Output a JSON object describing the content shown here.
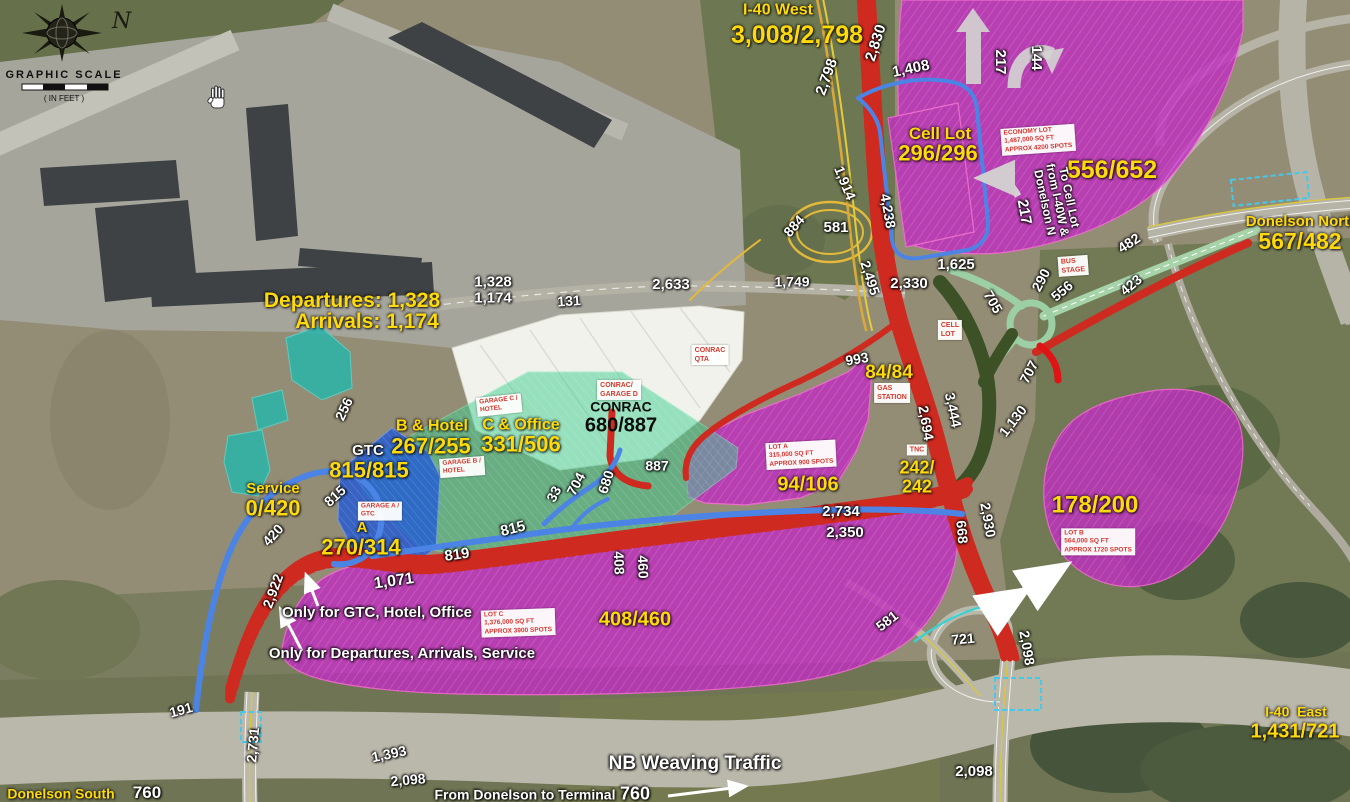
{
  "compass": {
    "n": "N",
    "scale_title": "GRAPHIC SCALE",
    "scale_units": "( IN FEET )"
  },
  "colors": {
    "lot_magenta": "#c02fc0",
    "garage_green": "#3ecf8f",
    "garage_blue": "#1f58d8",
    "curb_teal": "#2ab5ab",
    "road_red": "#cf2a20",
    "road_blue": "#4c84e6",
    "road_yellow": "#e5b93a",
    "road_pale_green": "#9ccfa4",
    "ramp_dark_green": "#3c5126",
    "label_yellow": "#ffd90a",
    "sign_red": "#d5372d"
  },
  "labels": [
    {
      "n": "label-i40-west",
      "t": "I-40 West",
      "x": 778,
      "y": 11,
      "r": 0,
      "s": 16,
      "c": "y"
    },
    {
      "n": "count-i40-west",
      "t": "3,008/2,798",
      "x": 797,
      "y": 35,
      "r": 0,
      "s": 25,
      "c": "y"
    },
    {
      "n": "label-cell-lot",
      "t": "Cell Lot",
      "x": 940,
      "y": 134,
      "r": 0,
      "s": 17,
      "c": "y"
    },
    {
      "n": "count-cell-lot",
      "t": "296/296",
      "x": 938,
      "y": 154,
      "r": 0,
      "s": 22,
      "c": "y"
    },
    {
      "n": "count-economy-lot",
      "t": "556/652",
      "x": 1112,
      "y": 170,
      "r": 0,
      "s": 25,
      "c": "y"
    },
    {
      "n": "label-donelson-north",
      "t": "Donelson North",
      "x": 1302,
      "y": 222,
      "r": 0,
      "s": 15,
      "c": "y"
    },
    {
      "n": "count-donelson-north",
      "t": "567/482",
      "x": 1300,
      "y": 242,
      "r": 0,
      "s": 23,
      "c": "y"
    },
    {
      "n": "label-departures",
      "t": "Departures: 1,328",
      "x": 352,
      "y": 301,
      "r": 0,
      "s": 21,
      "c": "y"
    },
    {
      "n": "label-arrivals",
      "t": "Arrivals: 1,174",
      "x": 367,
      "y": 322,
      "r": 0,
      "s": 21,
      "c": "y"
    },
    {
      "n": "label-garage-b-hotel",
      "t": "B & Hotel",
      "x": 432,
      "y": 427,
      "r": 0,
      "s": 16,
      "c": "y"
    },
    {
      "n": "count-garage-b-hotel",
      "t": "267/255",
      "x": 431,
      "y": 447,
      "r": 0,
      "s": 22,
      "c": "y"
    },
    {
      "n": "label-garage-c-office",
      "t": "C & Office",
      "x": 521,
      "y": 426,
      "r": 0,
      "s": 16,
      "c": "y"
    },
    {
      "n": "count-garage-c-office",
      "t": "331/506",
      "x": 521,
      "y": 445,
      "r": 0,
      "s": 22,
      "c": "y"
    },
    {
      "n": "label-gtc",
      "t": "GTC",
      "x": 368,
      "y": 451,
      "r": 0,
      "s": 15,
      "c": "w"
    },
    {
      "n": "count-gtc",
      "t": "815/815",
      "x": 369,
      "y": 471,
      "r": 0,
      "s": 22,
      "c": "y"
    },
    {
      "n": "label-garage-a",
      "t": "A",
      "x": 362,
      "y": 528,
      "r": 0,
      "s": 15,
      "c": "y"
    },
    {
      "n": "count-garage-a",
      "t": "270/314",
      "x": 361,
      "y": 548,
      "r": 0,
      "s": 22,
      "c": "y"
    },
    {
      "n": "label-service",
      "t": "Service",
      "x": 273,
      "y": 489,
      "r": 0,
      "s": 15,
      "c": "y"
    },
    {
      "n": "count-service",
      "t": "0/420",
      "x": 273,
      "y": 509,
      "r": 0,
      "s": 22,
      "c": "y"
    },
    {
      "n": "count-lot-a",
      "t": "94/106",
      "x": 808,
      "y": 485,
      "r": 0,
      "s": 20,
      "c": "y"
    },
    {
      "n": "count-gas-station",
      "t": "84/84",
      "x": 889,
      "y": 373,
      "r": 0,
      "s": 19,
      "c": "y"
    },
    {
      "n": "count-tnc",
      "t": "242/\n242",
      "x": 917,
      "y": 477,
      "r": 0,
      "s": 18,
      "c": "y"
    },
    {
      "n": "count-lot-c",
      "t": "408/460",
      "x": 635,
      "y": 620,
      "r": 0,
      "s": 20,
      "c": "y"
    },
    {
      "n": "count-lot-b",
      "t": "178/200",
      "x": 1095,
      "y": 506,
      "r": 0,
      "s": 24,
      "c": "y"
    },
    {
      "n": "label-i40-east",
      "t": "I-40  East",
      "x": 1296,
      "y": 712,
      "r": 0,
      "s": 14,
      "c": "y"
    },
    {
      "n": "count-i40-east",
      "t": "1,431/721",
      "x": 1295,
      "y": 732,
      "r": 0,
      "s": 20,
      "c": "y"
    },
    {
      "n": "label-donelson-south",
      "t": "Donelson South",
      "x": 61,
      "y": 794,
      "r": 0,
      "s": 14,
      "c": "y"
    },
    {
      "n": "count-2798",
      "t": "2,798",
      "x": 827,
      "y": 77,
      "r": -70,
      "s": 15,
      "c": "w"
    },
    {
      "n": "count-2830",
      "t": "2,830",
      "x": 876,
      "y": 43,
      "r": -72,
      "s": 15,
      "c": "w"
    },
    {
      "n": "count-1408",
      "t": "1,408",
      "x": 911,
      "y": 69,
      "r": -12,
      "s": 15,
      "c": "w"
    },
    {
      "n": "count-217-up",
      "t": "217",
      "x": 1000,
      "y": 62,
      "r": 90,
      "s": 15,
      "c": "w"
    },
    {
      "n": "count-144",
      "t": "144",
      "x": 1036,
      "y": 58,
      "r": 90,
      "s": 15,
      "c": "w"
    },
    {
      "n": "count-217-cell",
      "t": "217",
      "x": 1024,
      "y": 212,
      "r": 80,
      "s": 15,
      "c": "w"
    },
    {
      "n": "note-to-cell-lot",
      "t": "To Cell Lot\nfrom I-40W &\nDonelson N",
      "x": 1057,
      "y": 200,
      "r": 78,
      "s": 12,
      "c": "w"
    },
    {
      "n": "count-1914",
      "t": "1,914",
      "x": 845,
      "y": 183,
      "r": 68,
      "s": 14,
      "c": "w"
    },
    {
      "n": "count-4238",
      "t": "4,238",
      "x": 888,
      "y": 211,
      "r": 80,
      "s": 14,
      "c": "w"
    },
    {
      "n": "count-884",
      "t": "884",
      "x": 794,
      "y": 226,
      "r": -48,
      "s": 14,
      "c": "w"
    },
    {
      "n": "count-581-loop",
      "t": "581",
      "x": 836,
      "y": 228,
      "r": 0,
      "s": 15,
      "c": "w"
    },
    {
      "n": "count-1749",
      "t": "1,749",
      "x": 792,
      "y": 282,
      "r": 0,
      "s": 14,
      "c": "w"
    },
    {
      "n": "count-2495",
      "t": "2,495",
      "x": 870,
      "y": 278,
      "r": 72,
      "s": 14,
      "c": "w"
    },
    {
      "n": "count-2330",
      "t": "2,330",
      "x": 909,
      "y": 284,
      "r": 0,
      "s": 15,
      "c": "w"
    },
    {
      "n": "count-1625",
      "t": "1,625",
      "x": 956,
      "y": 265,
      "r": 0,
      "s": 15,
      "c": "w"
    },
    {
      "n": "count-705",
      "t": "705",
      "x": 993,
      "y": 302,
      "r": 60,
      "s": 14,
      "c": "w"
    },
    {
      "n": "count-290",
      "t": "290",
      "x": 1041,
      "y": 280,
      "r": -62,
      "s": 14,
      "c": "w"
    },
    {
      "n": "count-556",
      "t": "556",
      "x": 1062,
      "y": 291,
      "r": -40,
      "s": 14,
      "c": "w"
    },
    {
      "n": "count-482",
      "t": "482",
      "x": 1129,
      "y": 243,
      "r": -33,
      "s": 14,
      "c": "w"
    },
    {
      "n": "count-423",
      "t": "423",
      "x": 1131,
      "y": 285,
      "r": -40,
      "s": 14,
      "c": "w"
    },
    {
      "n": "count-707",
      "t": "707",
      "x": 1029,
      "y": 372,
      "r": -62,
      "s": 14,
      "c": "w"
    },
    {
      "n": "count-1130",
      "t": "1,130",
      "x": 1013,
      "y": 421,
      "r": -52,
      "s": 14,
      "c": "w"
    },
    {
      "n": "count-3444",
      "t": "3,444",
      "x": 953,
      "y": 410,
      "r": 78,
      "s": 14,
      "c": "w"
    },
    {
      "n": "count-2694",
      "t": "2,694",
      "x": 926,
      "y": 423,
      "r": 80,
      "s": 14,
      "c": "w"
    },
    {
      "n": "count-993",
      "t": "993",
      "x": 857,
      "y": 359,
      "r": -10,
      "s": 14,
      "c": "w"
    },
    {
      "n": "count-2734",
      "t": "2,734",
      "x": 841,
      "y": 512,
      "r": 0,
      "s": 15,
      "c": "w"
    },
    {
      "n": "count-2350",
      "t": "2,350",
      "x": 845,
      "y": 533,
      "r": 0,
      "s": 15,
      "c": "w"
    },
    {
      "n": "count-668",
      "t": "668",
      "x": 962,
      "y": 532,
      "r": 85,
      "s": 14,
      "c": "w"
    },
    {
      "n": "count-2930",
      "t": "2,930",
      "x": 988,
      "y": 520,
      "r": 80,
      "s": 14,
      "c": "w"
    },
    {
      "n": "count-887",
      "t": "887",
      "x": 657,
      "y": 466,
      "r": 0,
      "s": 14,
      "c": "w"
    },
    {
      "n": "count-680",
      "t": "680",
      "x": 606,
      "y": 482,
      "r": -72,
      "s": 14,
      "c": "w"
    },
    {
      "n": "count-704",
      "t": "704",
      "x": 576,
      "y": 484,
      "r": -62,
      "s": 14,
      "c": "w"
    },
    {
      "n": "count-33",
      "t": "33",
      "x": 554,
      "y": 494,
      "r": -62,
      "s": 14,
      "c": "w"
    },
    {
      "n": "count-815-road",
      "t": "815",
      "x": 513,
      "y": 529,
      "r": -14,
      "s": 15,
      "c": "w"
    },
    {
      "n": "count-815-gtc",
      "t": "815",
      "x": 335,
      "y": 496,
      "r": -42,
      "s": 14,
      "c": "w"
    },
    {
      "n": "count-819",
      "t": "819",
      "x": 457,
      "y": 555,
      "r": -8,
      "s": 15,
      "c": "w"
    },
    {
      "n": "count-1071",
      "t": "1,071",
      "x": 394,
      "y": 582,
      "r": -8,
      "s": 16,
      "c": "w"
    },
    {
      "n": "count-2922",
      "t": "2,922",
      "x": 273,
      "y": 591,
      "r": -70,
      "s": 14,
      "c": "w"
    },
    {
      "n": "count-420",
      "t": "420",
      "x": 273,
      "y": 535,
      "r": -48,
      "s": 14,
      "c": "w"
    },
    {
      "n": "count-256",
      "t": "256",
      "x": 344,
      "y": 409,
      "r": -65,
      "s": 14,
      "c": "w"
    },
    {
      "n": "count-408",
      "t": "408",
      "x": 619,
      "y": 563,
      "r": 88,
      "s": 14,
      "c": "w"
    },
    {
      "n": "count-460",
      "t": "460",
      "x": 643,
      "y": 567,
      "r": 88,
      "s": 14,
      "c": "w"
    },
    {
      "n": "count-131",
      "t": "131",
      "x": 569,
      "y": 301,
      "r": -4,
      "s": 14,
      "c": "w"
    },
    {
      "n": "count-2633",
      "t": "2,633",
      "x": 671,
      "y": 285,
      "r": 0,
      "s": 15,
      "c": "w"
    },
    {
      "n": "count-curb-stack",
      "t": "1,328\n1,174",
      "x": 493,
      "y": 290,
      "r": 0,
      "s": 15,
      "c": "w"
    },
    {
      "n": "count-581-ramp",
      "t": "581",
      "x": 887,
      "y": 621,
      "r": -38,
      "s": 14,
      "c": "w"
    },
    {
      "n": "count-721",
      "t": "721",
      "x": 963,
      "y": 639,
      "r": -5,
      "s": 14,
      "c": "w"
    },
    {
      "n": "count-2098-vert",
      "t": "2,098",
      "x": 1027,
      "y": 648,
      "r": 80,
      "s": 14,
      "c": "w"
    },
    {
      "n": "count-191",
      "t": "191",
      "x": 181,
      "y": 710,
      "r": -15,
      "s": 14,
      "c": "w"
    },
    {
      "n": "count-2731",
      "t": "2,731",
      "x": 253,
      "y": 745,
      "r": -85,
      "s": 14,
      "c": "w"
    },
    {
      "n": "count-1393",
      "t": "1,393",
      "x": 389,
      "y": 754,
      "r": -12,
      "s": 14,
      "c": "w"
    },
    {
      "n": "count-2098-left",
      "t": "2,098",
      "x": 408,
      "y": 780,
      "r": -5,
      "s": 14,
      "c": "w"
    },
    {
      "n": "count-760-left",
      "t": "760",
      "x": 147,
      "y": 793,
      "r": 0,
      "s": 17,
      "c": "w"
    },
    {
      "n": "note-from-donelson",
      "t": "From Donelson to Terminal",
      "x": 525,
      "y": 795,
      "r": 0,
      "s": 14,
      "c": "w"
    },
    {
      "n": "count-760-mid",
      "t": "760",
      "x": 635,
      "y": 794,
      "r": 0,
      "s": 18,
      "c": "w"
    },
    {
      "n": "label-nb-weaving",
      "t": "NB Weaving Traffic",
      "x": 695,
      "y": 764,
      "r": 0,
      "s": 19,
      "c": "w"
    },
    {
      "n": "count-2098-right",
      "t": "2,098",
      "x": 974,
      "y": 772,
      "r": 0,
      "s": 15,
      "c": "w"
    },
    {
      "n": "note-only-gtc",
      "t": "Only for GTC, Hotel, Office",
      "x": 377,
      "y": 613,
      "r": 0,
      "s": 15,
      "c": "w"
    },
    {
      "n": "note-only-departures",
      "t": "Only for Departures, Arrivals, Service",
      "x": 402,
      "y": 654,
      "r": 0,
      "s": 15,
      "c": "w"
    },
    {
      "n": "label-conrac",
      "t": "CONRAC",
      "x": 621,
      "y": 407,
      "r": 0,
      "s": 14,
      "c": "b"
    },
    {
      "n": "count-conrac",
      "t": "680/887",
      "x": 621,
      "y": 426,
      "r": 0,
      "s": 20,
      "c": "b"
    },
    {
      "n": "sign-economy-lot",
      "t": "ECONOMY LOT\n1,487,000 SQ FT\nAPPROX 4200 SPOTS",
      "x": 1038,
      "y": 140,
      "r": -4,
      "s": 6.5,
      "c": "s"
    },
    {
      "n": "sign-conrac-qta",
      "t": "CONRAC\nQTA",
      "x": 710,
      "y": 355,
      "r": 0,
      "s": 7,
      "c": "s"
    },
    {
      "n": "sign-conrac-garage-d",
      "t": "CONRAC/\nGARAGE D",
      "x": 619,
      "y": 390,
      "r": 0,
      "s": 7,
      "c": "s"
    },
    {
      "n": "sign-garage-c",
      "t": "GARAGE C /\nHOTEL",
      "x": 499,
      "y": 405,
      "r": -6,
      "s": 6.5,
      "c": "s"
    },
    {
      "n": "sign-garage-b",
      "t": "GARAGE B /\nHOTEL",
      "x": 462,
      "y": 467,
      "r": -4,
      "s": 6.5,
      "c": "s"
    },
    {
      "n": "sign-garage-a",
      "t": "GARAGE A /\nGTC",
      "x": 380,
      "y": 511,
      "r": 0,
      "s": 6.5,
      "c": "s"
    },
    {
      "n": "sign-lot-a",
      "t": "LOT A\n315,000 SQ FT\nAPPROX 900 SPOTS",
      "x": 801,
      "y": 455,
      "r": -3,
      "s": 6.5,
      "c": "s"
    },
    {
      "n": "sign-gas-station",
      "t": "GAS\nSTATION",
      "x": 892,
      "y": 393,
      "r": 0,
      "s": 7,
      "c": "s"
    },
    {
      "n": "sign-tnc",
      "t": "TNC",
      "x": 917,
      "y": 450,
      "r": 0,
      "s": 7,
      "c": "s"
    },
    {
      "n": "sign-cell-lot",
      "t": "CELL\nLOT",
      "x": 950,
      "y": 330,
      "r": 0,
      "s": 7,
      "c": "s"
    },
    {
      "n": "sign-bus-stage",
      "t": "BUS\nSTAGE",
      "x": 1073,
      "y": 266,
      "r": -4,
      "s": 7,
      "c": "s"
    },
    {
      "n": "sign-lot-b",
      "t": "LOT B\n564,000 SQ FT\nAPPROX 1720 SPOTS",
      "x": 1098,
      "y": 542,
      "r": 0,
      "s": 6.5,
      "c": "s"
    },
    {
      "n": "sign-lot-c",
      "t": "LOT C\n1,376,000 SQ FT\nAPPROX 3900 SPOTS",
      "x": 518,
      "y": 623,
      "r": -2,
      "s": 6.5,
      "c": "s"
    }
  ]
}
